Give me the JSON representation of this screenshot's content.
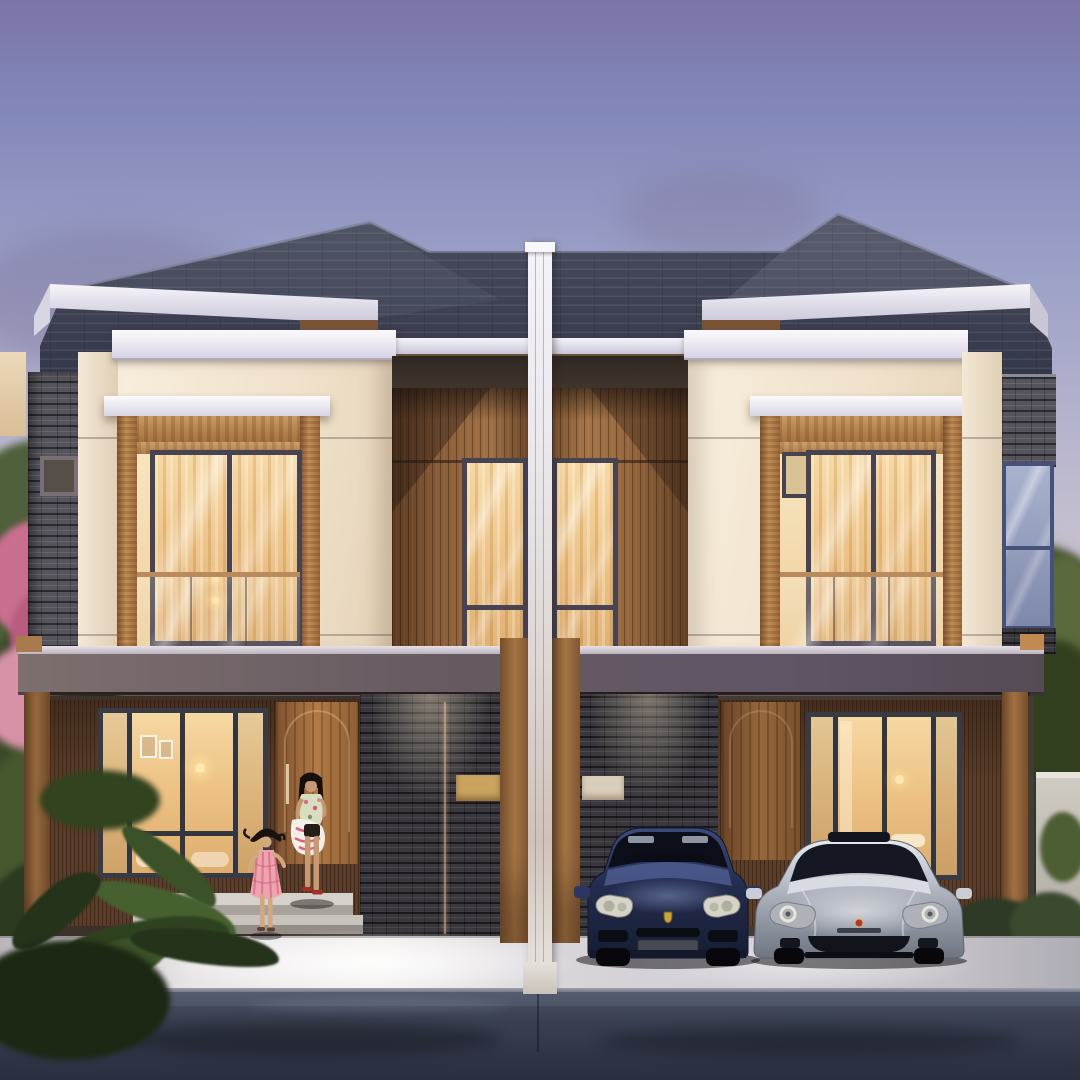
{
  "scene": {
    "type": "architectural-render",
    "description": "Photorealistic dusk rendering of a symmetrical two-storey modern tropical duplex (twin houses sharing a white party wall). Warm interior lights glow through large windows. The left porch shows a mother carrying a patterned bag and a little girl in a pink dress running down the steps. The right carport holds a dark blue SUV and a silver sedan. Stacked-stone feature walls, teak wood panels, glass balconies, flowering tree at left, trees at right, concrete driveway and dark asphalt road in front.",
    "time_of_day": "dusk",
    "houses": [
      {
        "id": "left-unit",
        "features": [
          "stacked-stone pillar with small window",
          "cream render walls with white cap moldings",
          "teak-framed balcony opening with glass balustrade",
          "vertical teak panel with tall window",
          "ground-floor living-room window",
          "arched teak entry door",
          "stacked-stone feature wall with gold address plate",
          "entry steps",
          "timber carport posts"
        ]
      },
      {
        "id": "right-unit",
        "features": [
          "glass corner window with stone band",
          "cream render walls with white cap moldings",
          "teak-framed balcony opening with glass balustrade",
          "vertical teak panel with tall window",
          "ground-floor bedroom window",
          "arched teak entry door",
          "stacked-stone feature wall with light address plate",
          "carport with two cars",
          "white side fence with hedge"
        ]
      }
    ],
    "vehicles": [
      {
        "name": "dark-blue-suv",
        "style": "Porsche-Cayenne-like",
        "color_key": "suv_blue"
      },
      {
        "name": "silver-sedan",
        "style": "Porsche-Panamera-like",
        "color_key": "sedan_silver"
      }
    ],
    "people": [
      {
        "name": "mother",
        "appearance": "long black hair, floral top, dark shorts, red flats, carrying white bag with pink pattern"
      },
      {
        "name": "daughter",
        "appearance": "young girl, dark flying hair, pink plaid dress, running down the steps"
      }
    ]
  },
  "palette": {
    "sky_top": "#7c74a8",
    "sky_mid": "#b3b2cd",
    "sky_horizon": "#f0d6b0",
    "cloud_mauve": "#8d7d99",
    "roof_tile_light": "#4a4e5e",
    "roof_tile_dark": "#33374a",
    "fascia_white": "#efecf4",
    "wall_cream": "#f2e6d3",
    "wood_teak": "#c28e56",
    "wood_panel": "#8a5d3a",
    "stone_gray": "#56545c",
    "stone_dark": "#3a383e",
    "canopy_fascia": "#5f5765",
    "post_wood": "#bb8350",
    "window_warm": "#ecc183",
    "window_frame": "#383b43",
    "glass_cool": "#9aa4c4",
    "balcony_rail_wood": "#b98a5c",
    "driveway_concrete": "#e8e5e6",
    "road_asphalt": "#343a48",
    "suv_blue": "#3e4a7c",
    "sedan_silver": "#e6eaee",
    "foliage_green": "#4a5d33",
    "flower_pink": "#c96e8e",
    "address_plate_gold": "#caa360",
    "address_plate_white": "#d9cebc",
    "skin": "#c89a74",
    "dress_pink": "#eda3b0"
  }
}
